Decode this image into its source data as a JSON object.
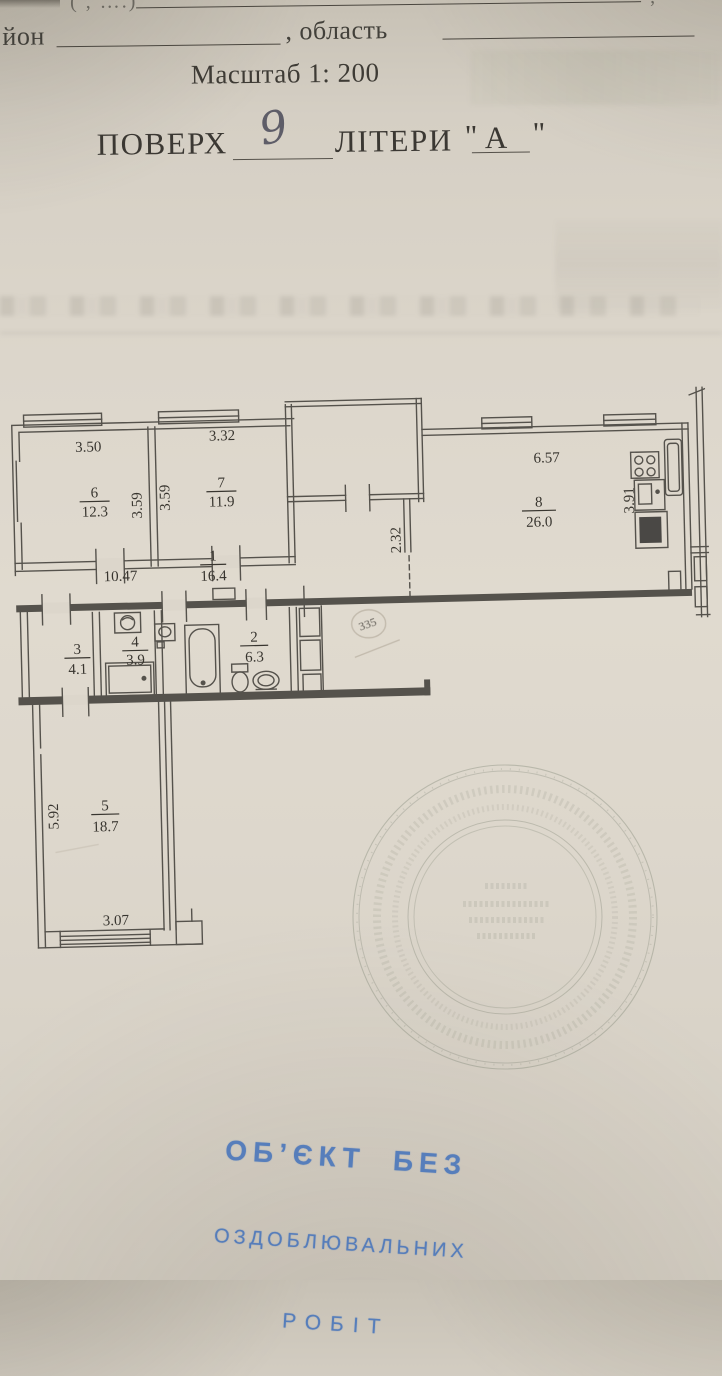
{
  "form": {
    "top_fragment": "( , ….)",
    "top_comma": ",",
    "district_label": "йон",
    "region_label": ", область",
    "scale_text": "Масштаб 1: 200",
    "floor_label": "ПОВЕРХ",
    "floor_value": "9",
    "letters_label": "ЛІТЕРИ",
    "quote_open": "\"",
    "letters_value": "А",
    "quote_close": "\""
  },
  "plan": {
    "rooms": [
      {
        "num": "1",
        "area": "16.4"
      },
      {
        "num": "2",
        "area": "6.3"
      },
      {
        "num": "3",
        "area": "4.1"
      },
      {
        "num": "4",
        "area": "3.9"
      },
      {
        "num": "5",
        "area": "18.7"
      },
      {
        "num": "6",
        "area": "12.3"
      },
      {
        "num": "7",
        "area": "11.9"
      },
      {
        "num": "8",
        "area": "26.0"
      }
    ],
    "dims": {
      "room6_width": "3.50",
      "room7_width": "3.32",
      "room6_depth": "3.59",
      "room7_depth": "3.59",
      "corridor_length": "10.47",
      "corridor_width": "2.32",
      "kitchen_width": "6.57",
      "kitchen_depth": "3.91",
      "room5_depth": "5.92",
      "room5_width": "3.07"
    },
    "pencil_note": "335"
  },
  "ink_stamp": {
    "line1": "ОБ’ЄКТ  БЕЗ",
    "line2": "ОЗДОБЛЮВАЛЬНИХ",
    "line3": "РОБІТ",
    "color": "#4d78bb"
  },
  "colors": {
    "paper": "#dcd6cb",
    "line": "#55524c",
    "seal": "#7c8272"
  }
}
